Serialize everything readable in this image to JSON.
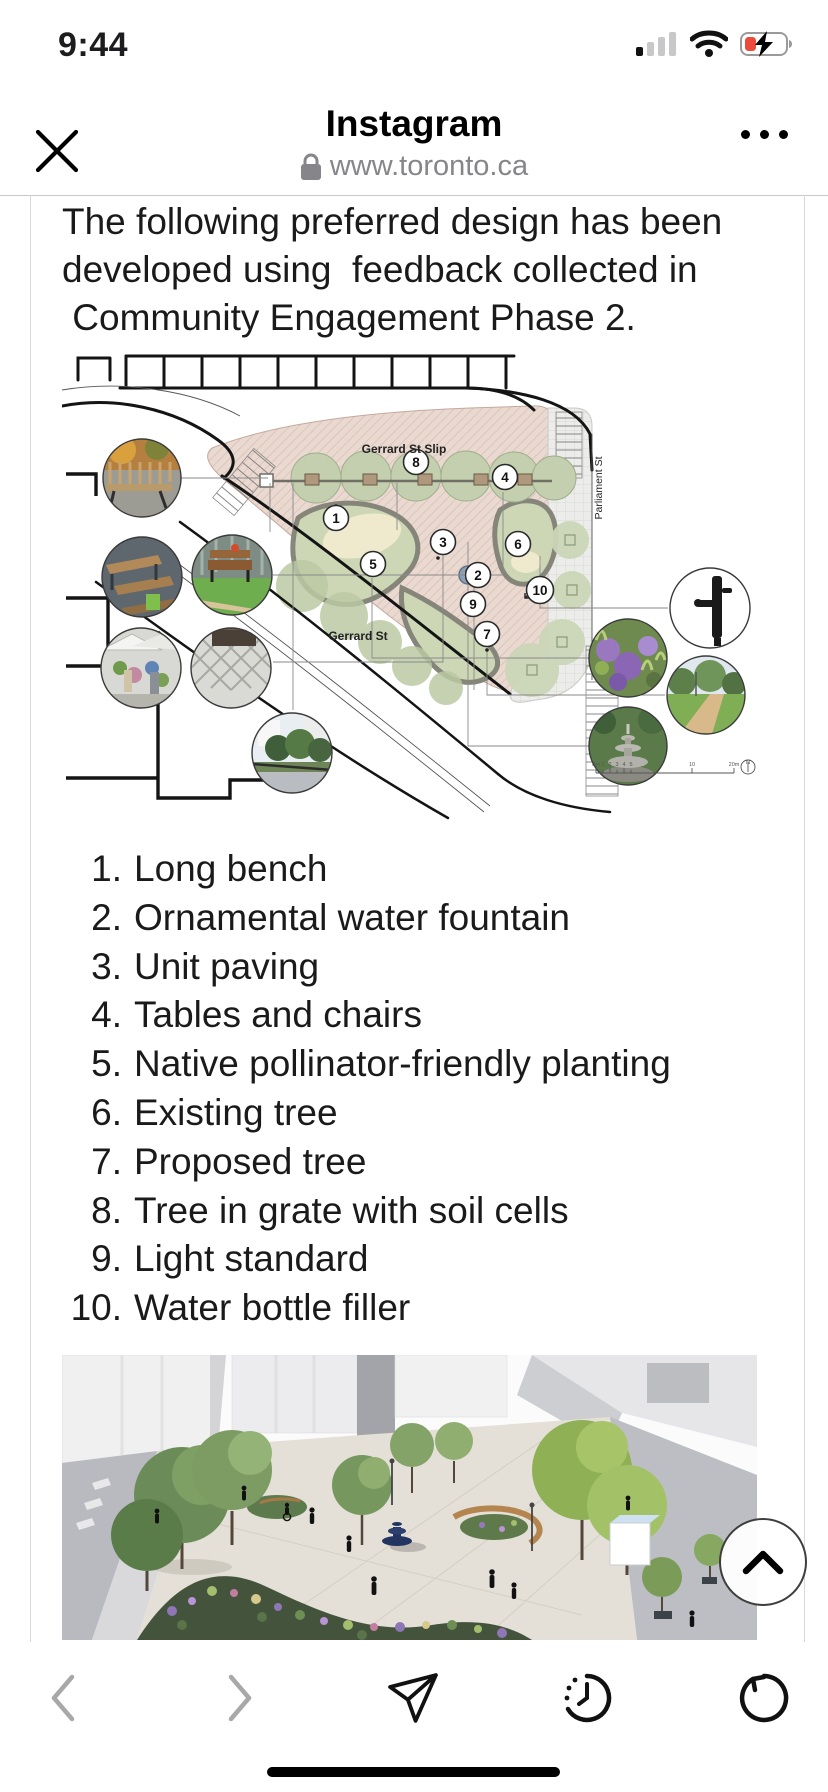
{
  "status_bar": {
    "time": "9:44",
    "icons": {
      "cellular": "cellular-signal-icon (1 of 4 bars)",
      "wifi": "wifi-icon (full)",
      "battery": "battery-charging-icon (low, red)"
    },
    "colors": {
      "battery_low": "#ec4b3c",
      "bar_dim": "#c8c8ca"
    }
  },
  "browser_header": {
    "app_title": "Instagram",
    "url": "www.toronto.ca",
    "icons": {
      "close": "close-icon",
      "lock": "lock-icon",
      "more": "ellipsis-icon"
    }
  },
  "article": {
    "intro_lines": [
      "The following preferred design has been",
      "developed using  feedback collected in",
      " Community Engagement Phase 2."
    ],
    "legend_items": [
      {
        "number": "1.",
        "label": "Long bench"
      },
      {
        "number": "2.",
        "label": "Ornamental water fountain"
      },
      {
        "number": "3.",
        "label": "Unit paving"
      },
      {
        "number": "4.",
        "label": "Tables and chairs"
      },
      {
        "number": "5.",
        "label": "Native pollinator-friendly planting"
      },
      {
        "number": "6.",
        "label": "Existing tree"
      },
      {
        "number": "7.",
        "label": "Proposed tree"
      },
      {
        "number": "8.",
        "label": "Tree in grate with soil cells"
      },
      {
        "number": "9.",
        "label": "Light standard"
      },
      {
        "number": "10.",
        "label": "Water bottle filler"
      }
    ]
  },
  "site_plan": {
    "street_labels": {
      "slip": "Gerrard St Slip",
      "parliament": "Parliament St",
      "gerrard": "Gerrard St"
    },
    "callouts": [
      "1",
      "2",
      "3",
      "4",
      "5",
      "6",
      "7",
      "8",
      "9",
      "10"
    ],
    "scale_labels": [
      "0m",
      "1",
      "2",
      "3",
      "4",
      "5",
      "10",
      "20m"
    ],
    "north_label": "N",
    "colors": {
      "plaza_paving": "#ead9d0",
      "plaza_hatch": "#d9c0b5",
      "lawn": "#cdd7b6",
      "tree_canopy": "#c3cfae",
      "track_edge": "#85857a"
    }
  },
  "render_image": {
    "description": "3D aerial render of proposed plaza with trees, planting, fountain and people",
    "colors": {
      "plaza": "#e4e0d7",
      "road": "#b9babf",
      "planting": "#44543c",
      "fountain": "#22345f"
    }
  },
  "toolbar": {
    "icons": [
      "back-icon",
      "forward-icon",
      "share-icon",
      "history-icon",
      "reload-icon"
    ],
    "disabled_color": "#a8a8a8",
    "active_color": "#111111"
  },
  "scroll_top_button": {
    "icon": "chevron-up-icon"
  }
}
